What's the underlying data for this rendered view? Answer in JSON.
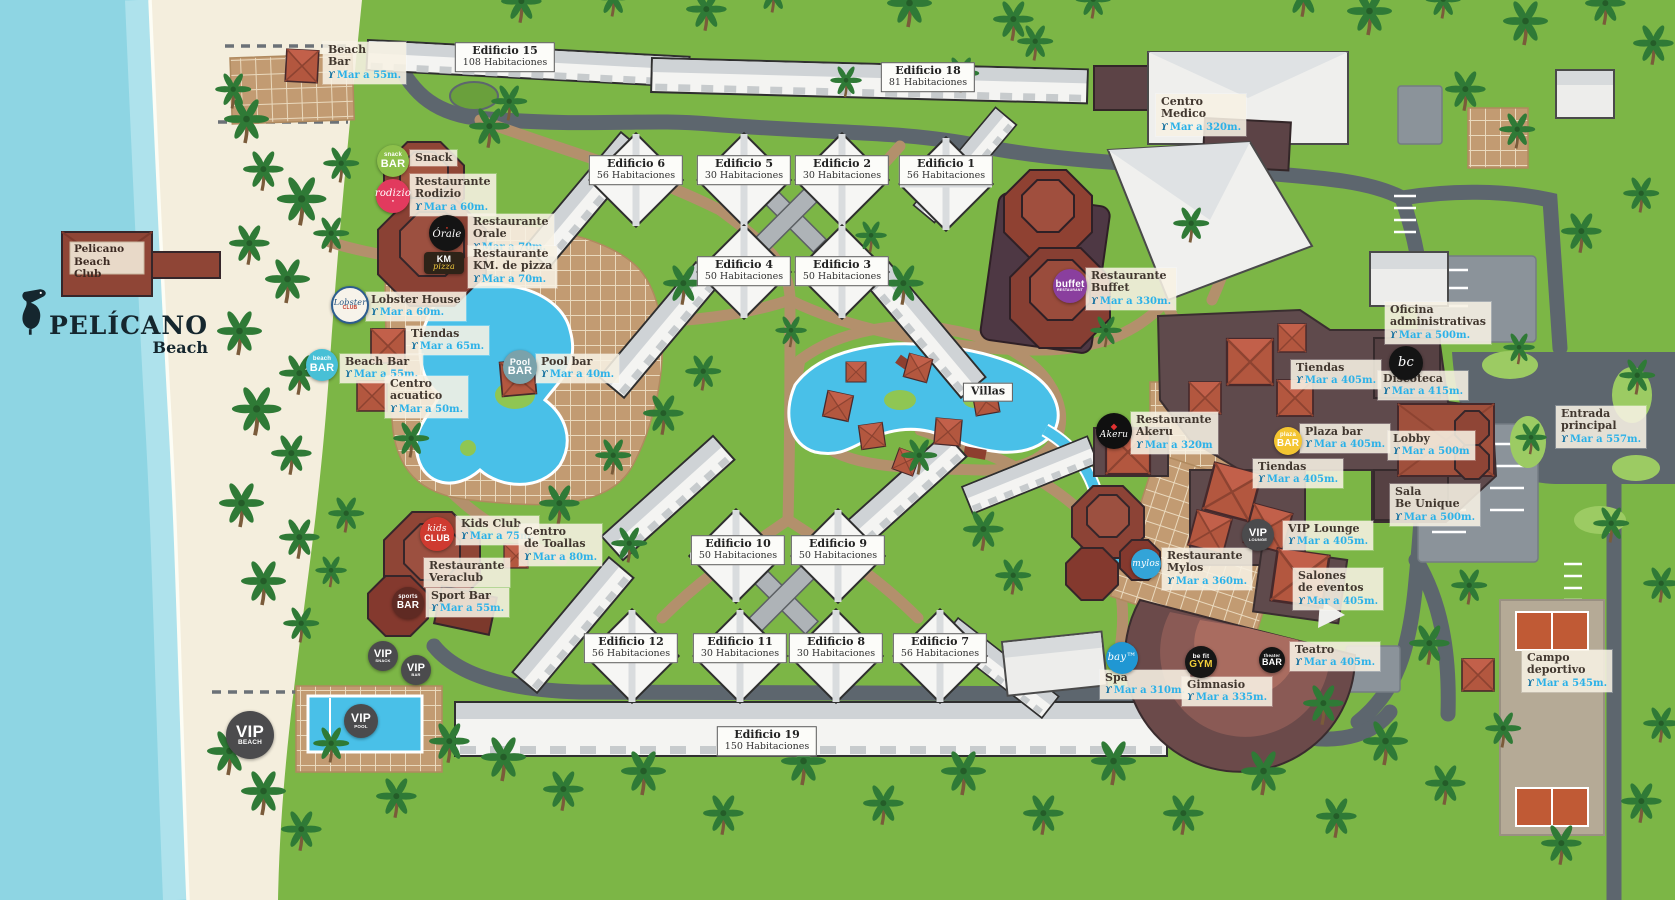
{
  "branding": {
    "sign": "Pelicano\nBeach Club",
    "logo_name": "PELÍCANO",
    "logo_sub": "Beach"
  },
  "map": {
    "distance_icon": "ϒ",
    "colors": {
      "sea": "#8ed5e3",
      "sand": "#f4eedd",
      "grass": "#7cb646",
      "road": "#5d666e",
      "path": "#b3906c",
      "pool": "#49c0e8",
      "distance_text": "#2bb1e8",
      "restaurant_red": "#8f4536",
      "facility": "#5f4a4c"
    },
    "building_labels": [
      {
        "id": "edificio-15",
        "name": "Edificio 15",
        "rooms": "108 Habitaciones",
        "x": 505,
        "y": 57
      },
      {
        "id": "edificio-18",
        "name": "Edificio 18",
        "rooms": "81 Habitaciones",
        "x": 928,
        "y": 77
      },
      {
        "id": "edificio-6",
        "name": "Edificio 6",
        "rooms": "56 Habitaciones",
        "x": 636,
        "y": 170
      },
      {
        "id": "edificio-5",
        "name": "Edificio 5",
        "rooms": "30 Habitaciones",
        "x": 744,
        "y": 170
      },
      {
        "id": "edificio-2",
        "name": "Edificio 2",
        "rooms": "30 Habitaciones",
        "x": 842,
        "y": 170
      },
      {
        "id": "edificio-1",
        "name": "Edificio 1",
        "rooms": "56 Habitaciones",
        "x": 946,
        "y": 170
      },
      {
        "id": "edificio-4",
        "name": "Edificio 4",
        "rooms": "50 Habitaciones",
        "x": 744,
        "y": 271
      },
      {
        "id": "edificio-3",
        "name": "Edificio 3",
        "rooms": "50 Habitaciones",
        "x": 842,
        "y": 271
      },
      {
        "id": "edificio-10",
        "name": "Edificio 10",
        "rooms": "50 Habitaciones",
        "x": 738,
        "y": 550
      },
      {
        "id": "edificio-9",
        "name": "Edificio 9",
        "rooms": "50 Habitaciones",
        "x": 838,
        "y": 550
      },
      {
        "id": "edificio-12",
        "name": "Edificio 12",
        "rooms": "56 Habitaciones",
        "x": 631,
        "y": 648
      },
      {
        "id": "edificio-11",
        "name": "Edificio 11",
        "rooms": "30 Habitaciones",
        "x": 740,
        "y": 648
      },
      {
        "id": "edificio-8",
        "name": "Edificio 8",
        "rooms": "30 Habitaciones",
        "x": 836,
        "y": 648
      },
      {
        "id": "edificio-7",
        "name": "Edificio 7",
        "rooms": "56 Habitaciones",
        "x": 940,
        "y": 648
      },
      {
        "id": "edificio-19",
        "name": "Edificio 19",
        "rooms": "150 Habitaciones",
        "x": 767,
        "y": 741
      },
      {
        "id": "villas",
        "name": "Villas",
        "rooms": "",
        "x": 988,
        "y": 392
      }
    ],
    "pois": [
      {
        "id": "beach-bar-north",
        "name": "Beach\nBar",
        "distance": "Mar a 55m.",
        "x": 323,
        "y": 42
      },
      {
        "id": "snack",
        "name": "Snack",
        "distance": "",
        "x": 410,
        "y": 150
      },
      {
        "id": "restaurante-rodizio",
        "name": "Restaurante\nRodizio",
        "distance": "Mar a 60m.",
        "x": 410,
        "y": 174
      },
      {
        "id": "restaurante-orale",
        "name": "Restaurante\nOrale",
        "distance": "Mar a 70m.",
        "x": 468,
        "y": 214
      },
      {
        "id": "restaurante-km-pizza",
        "name": "Restaurante\nKM. de pizza",
        "distance": "Mar a 70m.",
        "x": 468,
        "y": 246
      },
      {
        "id": "lobster-house",
        "name": "Lobster House",
        "distance": "Mar a 60m.",
        "x": 366,
        "y": 292
      },
      {
        "id": "tiendas-oeste",
        "name": "Tiendas",
        "distance": "Mar a 65m.",
        "x": 406,
        "y": 326
      },
      {
        "id": "beach-bar-sur",
        "name": "Beach Bar",
        "distance": "Mar a 55m.",
        "x": 340,
        "y": 354
      },
      {
        "id": "centro-acuatico",
        "name": "Centro\nacuatico",
        "distance": "Mar a 50m.",
        "x": 385,
        "y": 376
      },
      {
        "id": "pool-bar",
        "name": "Pool bar",
        "distance": "Mar a 40m.",
        "x": 536,
        "y": 354
      },
      {
        "id": "centro-medico",
        "name": "Centro\nMedico",
        "distance": "Mar a 320m.",
        "x": 1156,
        "y": 94
      },
      {
        "id": "restaurante-buffet",
        "name": "Restaurante\nBuffet",
        "distance": "Mar a 330m.",
        "x": 1086,
        "y": 268
      },
      {
        "id": "restaurante-akeru",
        "name": "Restaurante\nAkeru",
        "distance": "Mar a 320m",
        "x": 1131,
        "y": 412
      },
      {
        "id": "oficina-administrativas",
        "name": "Oficina\nadministrativas",
        "distance": "Mar a 500m.",
        "x": 1385,
        "y": 302
      },
      {
        "id": "tiendas-norte",
        "name": "Tiendas",
        "distance": "Mar a 405m.",
        "x": 1291,
        "y": 360
      },
      {
        "id": "discoteca",
        "name": "Discoteca",
        "distance": "Mar a 415m.",
        "x": 1378,
        "y": 371
      },
      {
        "id": "plaza-bar",
        "name": "Plaza bar",
        "distance": "Mar a 405m.",
        "x": 1300,
        "y": 424
      },
      {
        "id": "lobby",
        "name": "Lobby",
        "distance": "Mar a 500m",
        "x": 1388,
        "y": 431
      },
      {
        "id": "entrada-principal",
        "name": "Entrada\nprincipal",
        "distance": "Mar a 557m.",
        "x": 1556,
        "y": 406
      },
      {
        "id": "tiendas-sur",
        "name": "Tiendas",
        "distance": "Mar a 405m.",
        "x": 1253,
        "y": 459
      },
      {
        "id": "sala-be-unique",
        "name": "Sala\nBe Unique",
        "distance": "Mar a 500m.",
        "x": 1390,
        "y": 484
      },
      {
        "id": "kids-club",
        "name": "Kids Club",
        "distance": "Mar a 75m.",
        "x": 456,
        "y": 516
      },
      {
        "id": "centro-de-toallas",
        "name": "Centro\nde Toallas",
        "distance": "Mar a 80m.",
        "x": 519,
        "y": 524
      },
      {
        "id": "vip-lounge",
        "name": "VIP Lounge",
        "distance": "Mar a 405m.",
        "x": 1283,
        "y": 521
      },
      {
        "id": "restaurante-mylos",
        "name": "Restaurante\nMylos",
        "distance": "Mar a 360m.",
        "x": 1162,
        "y": 548
      },
      {
        "id": "restaurante-veraclub",
        "name": "Restaurante\nVeraclub",
        "distance": "",
        "x": 424,
        "y": 558
      },
      {
        "id": "sport-bar",
        "name": "Sport Bar",
        "distance": "Mar a 55m.",
        "x": 426,
        "y": 588
      },
      {
        "id": "salones-de-eventos",
        "name": "Salones\nde eventos",
        "distance": "Mar a 405m.",
        "x": 1293,
        "y": 568
      },
      {
        "id": "teatro",
        "name": "Teatro",
        "distance": "Mar a 405m.",
        "x": 1290,
        "y": 642
      },
      {
        "id": "spa",
        "name": "Spa",
        "distance": "Mar a 310m.",
        "x": 1100,
        "y": 670
      },
      {
        "id": "gimnasio",
        "name": "Gimnasio",
        "distance": "Mar a 335m.",
        "x": 1182,
        "y": 677
      },
      {
        "id": "campo-deportivo",
        "name": "Campo\ndeportivo",
        "distance": "Mar a 545m.",
        "x": 1522,
        "y": 650
      }
    ],
    "badges": [
      {
        "id": "snack-bar",
        "x": 393,
        "y": 161,
        "r": 16,
        "bg": "#8dc04b",
        "lines": [
          {
            "t": "snack",
            "fs": 6
          },
          {
            "t": "BAR",
            "fs": 11
          }
        ]
      },
      {
        "id": "rodizio",
        "x": 393,
        "y": 196,
        "r": 17,
        "bg": "#e23a5e",
        "lines": [
          {
            "t": "rodizio",
            "fs": 10,
            "it": true
          },
          {
            "t": "●",
            "fs": 4,
            "c": "#ffd7df"
          }
        ]
      },
      {
        "id": "orale",
        "x": 447,
        "y": 233,
        "r": 18,
        "bg": "#141414",
        "lines": [
          {
            "t": "●",
            "fs": 4,
            "c": "#d03a2a"
          },
          {
            "t": "Órale",
            "fs": 10,
            "it": true
          }
        ]
      },
      {
        "id": "km-pizza",
        "x": 444,
        "y": 263,
        "shape": "rect",
        "w": 40,
        "h": 22,
        "bg": "#2e2318",
        "lines": [
          {
            "t": "KM",
            "fs": 9
          },
          {
            "t": "pizza",
            "fs": 8,
            "it": true,
            "c": "#f0c93c"
          }
        ]
      },
      {
        "id": "lobster-club",
        "x": 350,
        "y": 305,
        "r": 17,
        "bg": "#f7f3ea",
        "fg": "#1f4f7e",
        "border": "#2c5d8f",
        "lines": [
          {
            "t": "Lobster",
            "fs": 8,
            "it": true
          },
          {
            "t": "CLUB",
            "fs": 5,
            "c": "#c0392b"
          }
        ]
      },
      {
        "id": "beach-bar",
        "x": 322,
        "y": 365,
        "r": 16,
        "bg": "#48c0d6",
        "lines": [
          {
            "t": "beach",
            "fs": 6
          },
          {
            "t": "BAR",
            "fs": 11
          }
        ]
      },
      {
        "id": "pool-bar",
        "x": 520,
        "y": 367,
        "r": 17,
        "bg": "#7aa2ab",
        "lines": [
          {
            "t": "Pool",
            "fs": 9
          },
          {
            "t": "BAR",
            "fs": 11
          }
        ]
      },
      {
        "id": "buffet-restaurant",
        "x": 1070,
        "y": 286,
        "r": 17,
        "bg": "#8a3f9e",
        "lines": [
          {
            "t": "buffet",
            "fs": 10
          },
          {
            "t": "RESTAURANT",
            "fs": 3.5
          }
        ]
      },
      {
        "id": "akeru",
        "x": 1114,
        "y": 431,
        "r": 18,
        "bg": "#101010",
        "lines": [
          {
            "t": "◆",
            "fs": 8,
            "c": "#e03131"
          },
          {
            "t": "Akeru",
            "fs": 9,
            "it": true
          }
        ]
      },
      {
        "id": "plaza-bar",
        "x": 1288,
        "y": 441,
        "r": 14,
        "bg": "#f4c531",
        "lines": [
          {
            "t": "plaza",
            "fs": 6
          },
          {
            "t": "BAR",
            "fs": 10
          }
        ]
      },
      {
        "id": "bc",
        "x": 1406,
        "y": 363,
        "r": 17,
        "bg": "#141414",
        "lines": [
          {
            "t": "bc",
            "fs": 13,
            "it": true
          }
        ]
      },
      {
        "id": "vip-lounge",
        "x": 1258,
        "y": 535,
        "r": 16,
        "bg": "#4b4b4d",
        "lines": [
          {
            "t": "VIP",
            "fs": 11
          },
          {
            "t": "LOUNGE",
            "fs": 4
          }
        ]
      },
      {
        "id": "mylos",
        "x": 1146,
        "y": 564,
        "r": 15,
        "bg": "#33a4d8",
        "lines": [
          {
            "t": "mylos",
            "fs": 9,
            "it": true
          }
        ]
      },
      {
        "id": "sports-bar",
        "x": 408,
        "y": 603,
        "r": 16,
        "bg": "#5f2a23",
        "lines": [
          {
            "t": "sports",
            "fs": 6
          },
          {
            "t": "BAR",
            "fs": 10
          }
        ]
      },
      {
        "id": "kids-club",
        "x": 437,
        "y": 534,
        "r": 17,
        "bg": "#cf3a30",
        "lines": [
          {
            "t": "kids",
            "fs": 9,
            "it": true
          },
          {
            "t": "CLUB",
            "fs": 9
          }
        ]
      },
      {
        "id": "theater-bar",
        "x": 1272,
        "y": 660,
        "r": 13,
        "bg": "#141414",
        "lines": [
          {
            "t": "theater",
            "fs": 4.5
          },
          {
            "t": "BAR",
            "fs": 9
          }
        ]
      },
      {
        "id": "befit-gym",
        "x": 1201,
        "y": 662,
        "r": 16,
        "bg": "#161616",
        "lines": [
          {
            "t": "be fit",
            "fs": 6.5
          },
          {
            "t": "GYM",
            "fs": 10,
            "c": "#f2cf3a"
          }
        ]
      },
      {
        "id": "bay",
        "x": 1122,
        "y": 658,
        "r": 16,
        "bg": "#2097d3",
        "lines": [
          {
            "t": "bay™",
            "fs": 10,
            "it": true
          }
        ]
      },
      {
        "id": "vip-snack",
        "x": 383,
        "y": 656,
        "r": 15,
        "bg": "#4b4b4d",
        "lines": [
          {
            "t": "VIP",
            "fs": 11
          },
          {
            "t": "SNACK",
            "fs": 4
          }
        ]
      },
      {
        "id": "vip-bar",
        "x": 416,
        "y": 670,
        "r": 15,
        "bg": "#4b4b4d",
        "lines": [
          {
            "t": "VIP",
            "fs": 11
          },
          {
            "t": "BAR",
            "fs": 4
          }
        ]
      },
      {
        "id": "vip-pool",
        "x": 361,
        "y": 721,
        "r": 17,
        "bg": "#4b4b4d",
        "lines": [
          {
            "t": "VIP",
            "fs": 12
          },
          {
            "t": "POOL",
            "fs": 4.5
          }
        ]
      },
      {
        "id": "vip-beach",
        "x": 250,
        "y": 735,
        "r": 24,
        "bg": "#4b4b4d",
        "lines": [
          {
            "t": "VIP",
            "fs": 17
          },
          {
            "t": "BEACH",
            "fs": 6.5
          }
        ]
      }
    ]
  }
}
